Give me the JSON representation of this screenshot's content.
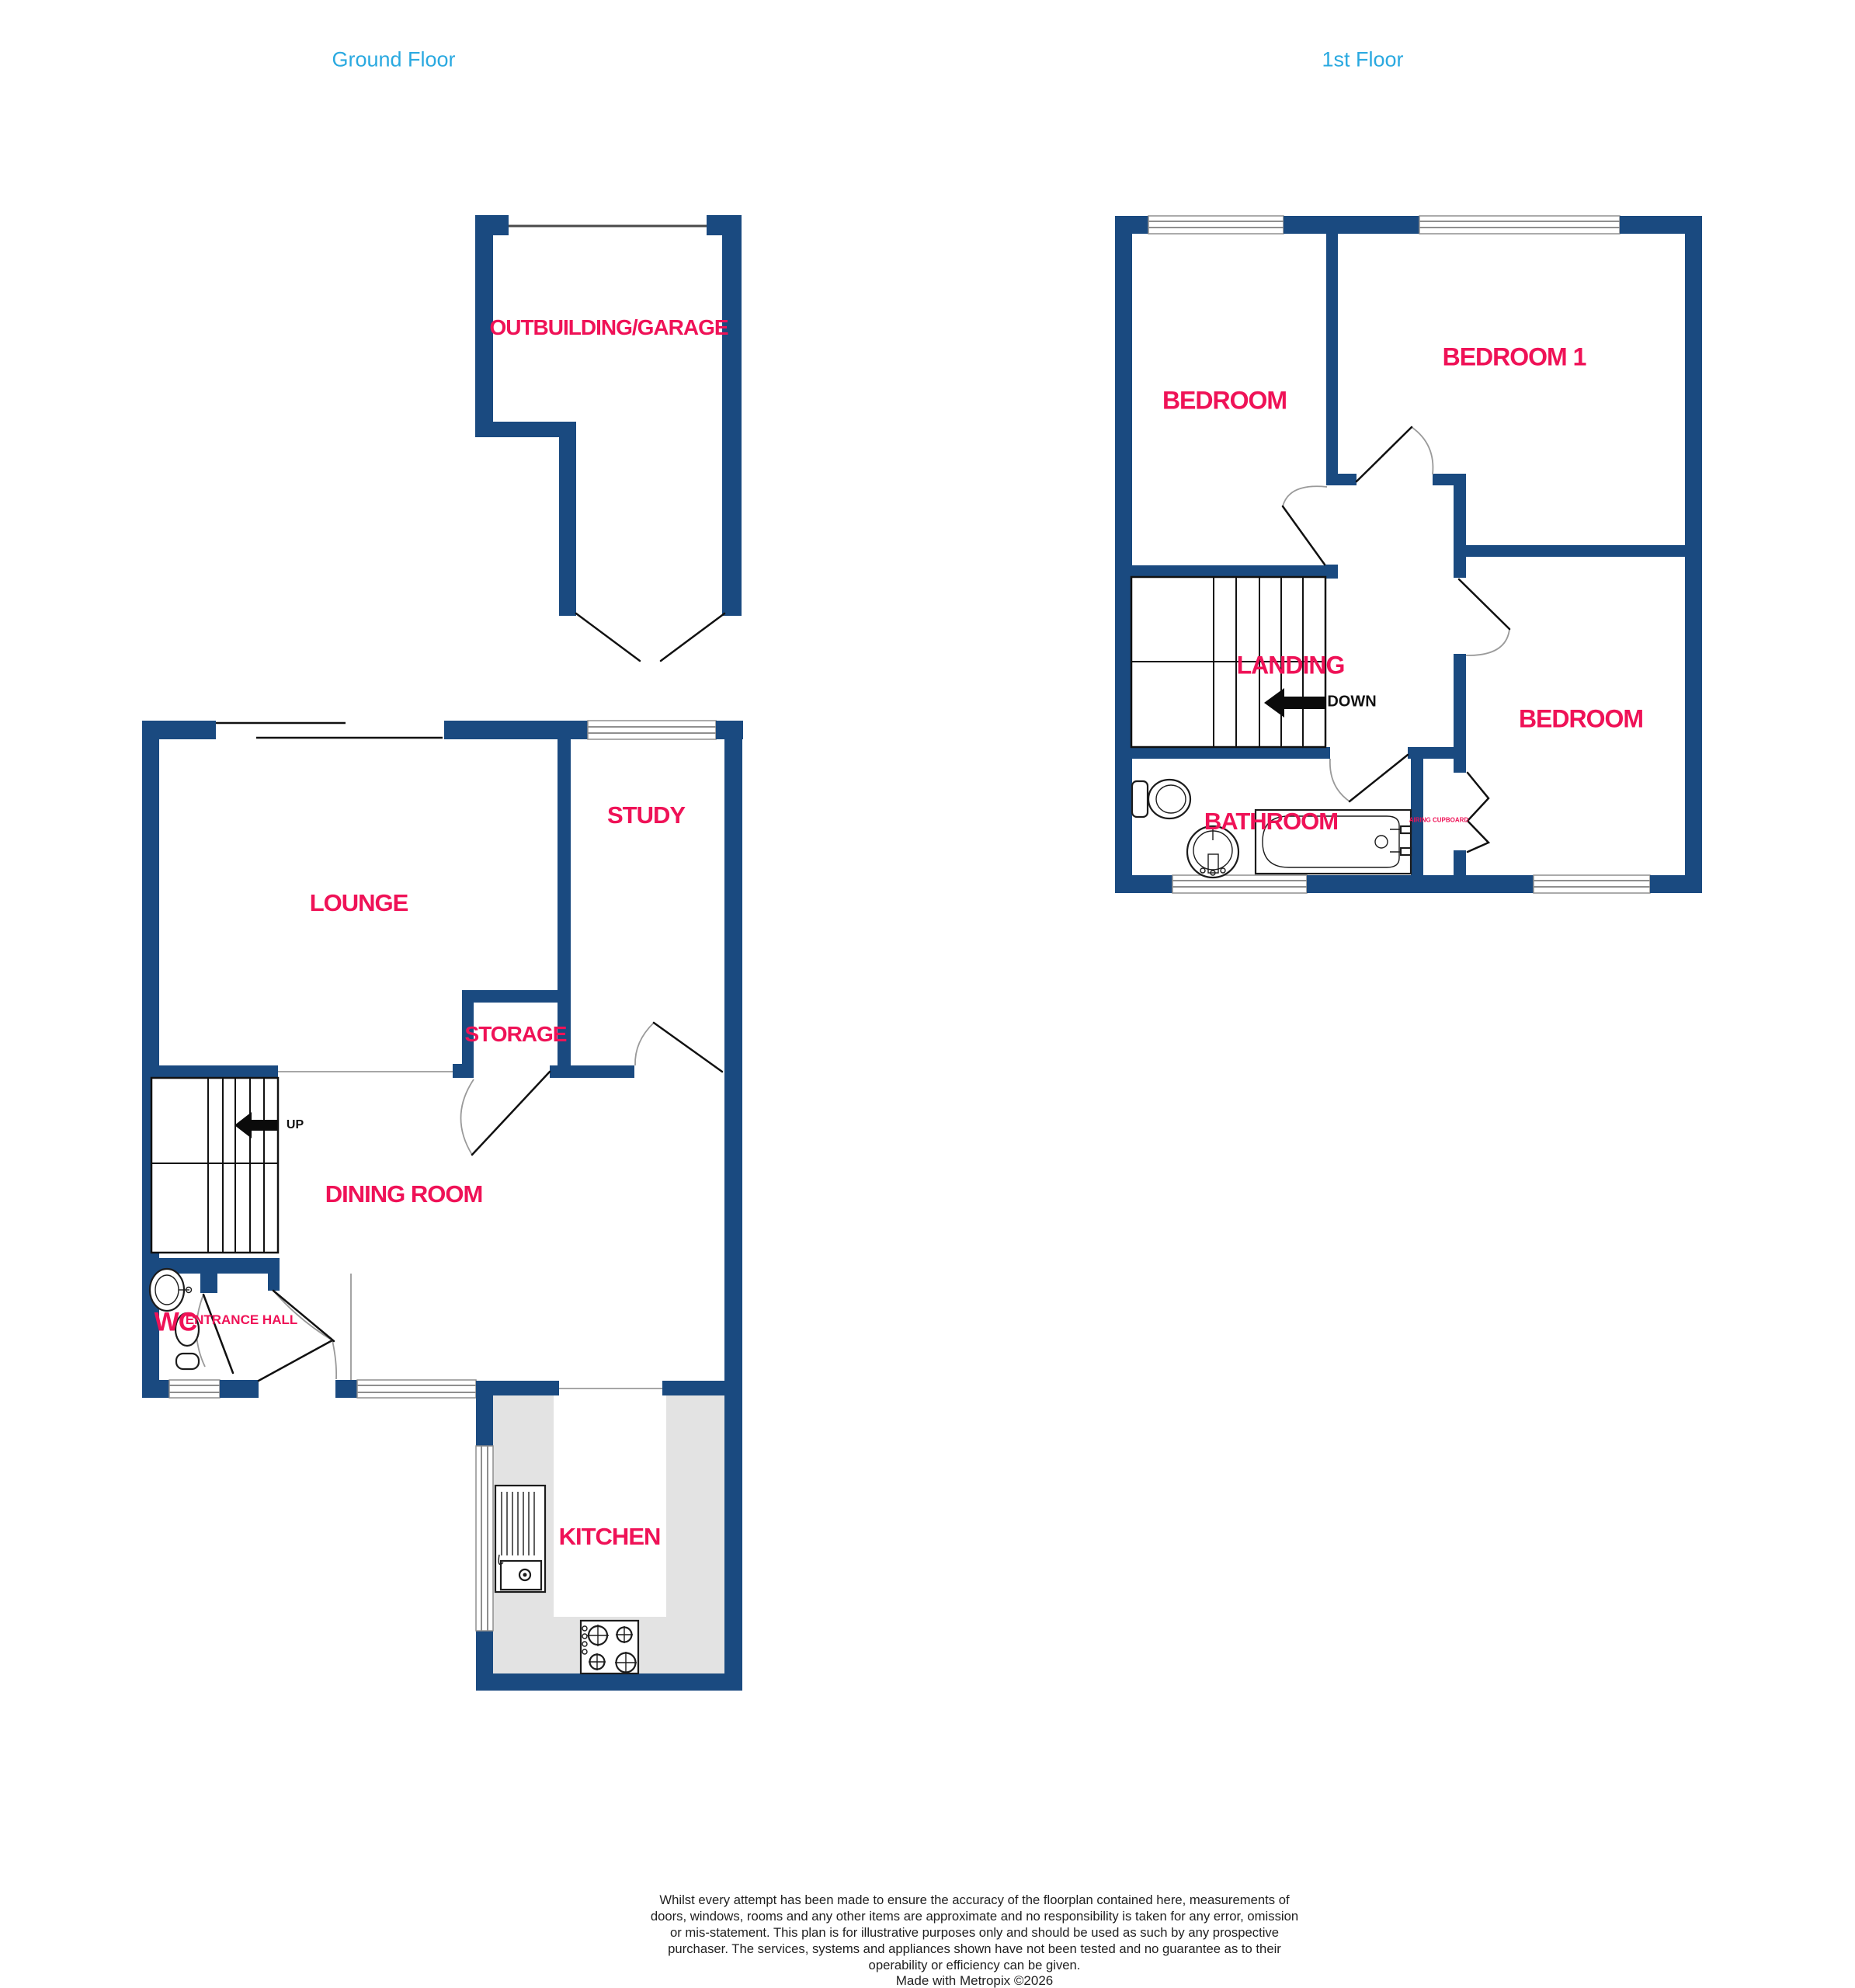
{
  "page": {
    "background": "#ffffff"
  },
  "colors": {
    "wall_navy": "#1a4a80",
    "room_label_pink": "#ef1257",
    "floor_title_blue": "#2aa9e0",
    "counter_gray": "#e3e3e3",
    "stair_text_black": "#111111"
  },
  "floors": {
    "ground": {
      "title": "Ground Floor",
      "stair_label": "UP",
      "rooms": {
        "outbuilding": {
          "label": "OUTBUILDING/GARAGE"
        },
        "lounge": {
          "label": "LOUNGE"
        },
        "study": {
          "label": "STUDY"
        },
        "storage": {
          "label": "STORAGE"
        },
        "dining_room": {
          "label": "DINING ROOM"
        },
        "wc": {
          "label": "WC"
        },
        "entrance_hall": {
          "label": "ENTRANCE HALL"
        },
        "kitchen": {
          "label": "KITCHEN"
        }
      }
    },
    "first": {
      "title": "1st Floor",
      "stair_label": "DOWN",
      "rooms": {
        "bedroom_left": {
          "label": "BEDROOM"
        },
        "bedroom_one": {
          "label": "BEDROOM 1"
        },
        "landing": {
          "label": "LANDING"
        },
        "bathroom": {
          "label": "BATHROOM"
        },
        "bedroom_right": {
          "label": "BEDROOM"
        },
        "airing_cupboard": {
          "label": "AIRING CUPBOARD"
        }
      }
    }
  },
  "footer": {
    "disclaimer": "Whilst every attempt has been made to ensure the accuracy of the floorplan contained here, measurements of doors, windows, rooms and any other items are approximate and no responsibility is taken for any error, omission or mis-statement. This plan is for illustrative purposes only and should be used as such by any prospective purchaser. The services, systems and appliances shown have not been tested and no guarantee as to their operability or efficiency can be given.",
    "credit": "Made with Metropix ©2026"
  }
}
